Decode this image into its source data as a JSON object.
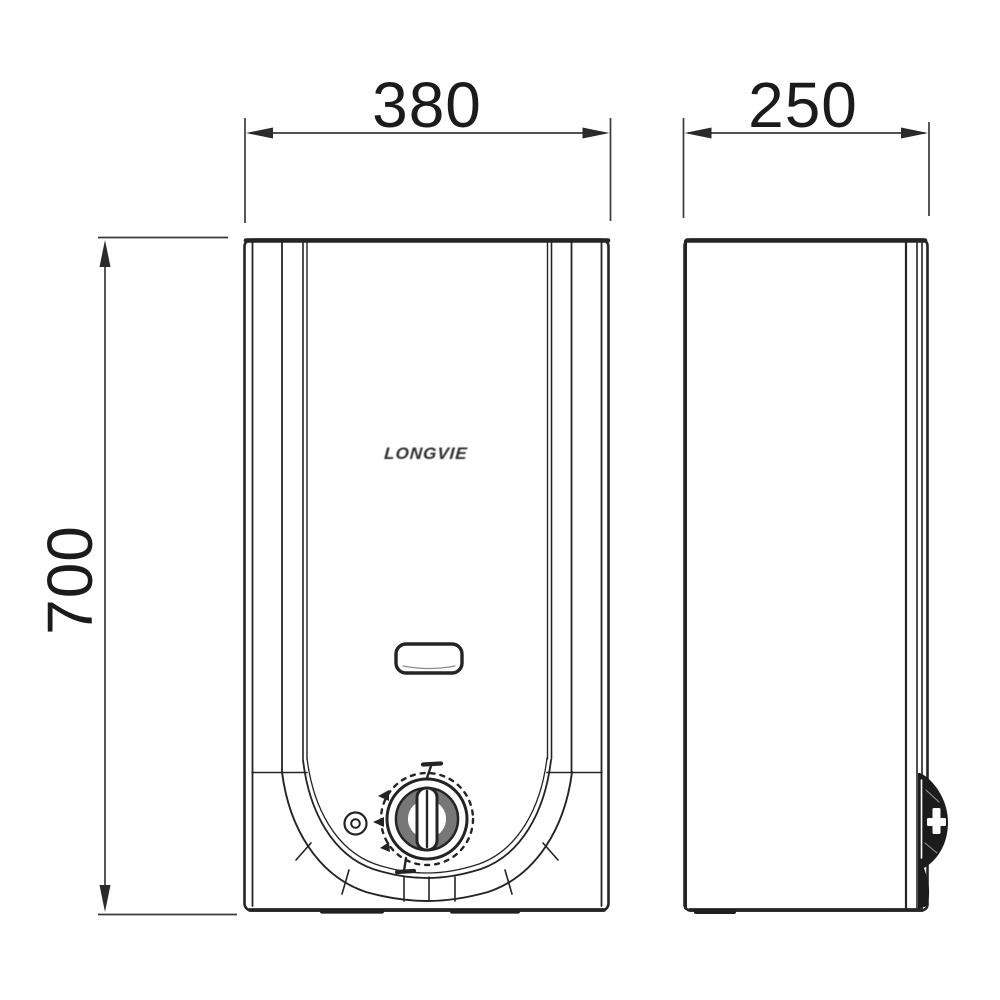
{
  "diagram": {
    "kind": "technical dimension drawing, two orthographic views of a wall-hung gas water heater",
    "brand_label": "LONGVIE",
    "dimensions": {
      "width": {
        "value": "380",
        "applies_to": "front view width",
        "orientation": "horizontal"
      },
      "depth": {
        "value": "250",
        "applies_to": "side view depth",
        "orientation": "horizontal"
      },
      "height": {
        "value": "700",
        "applies_to": "overall height",
        "orientation": "vertical-rotated"
      }
    },
    "views": {
      "front": {
        "name": "front view",
        "features": [
          "brand logo",
          "viewing window slot",
          "pilot indicator light",
          "control knob with position marks",
          "curved bottom trim band"
        ]
      },
      "side": {
        "name": "side view",
        "features": [
          "back mounting plate lines",
          "control knob protruding in profile"
        ]
      }
    },
    "colors": {
      "background": "#ffffff",
      "drawing_line": "#242424",
      "dimension_line": "#3a3a3a",
      "text": "#1b1b1b"
    }
  }
}
